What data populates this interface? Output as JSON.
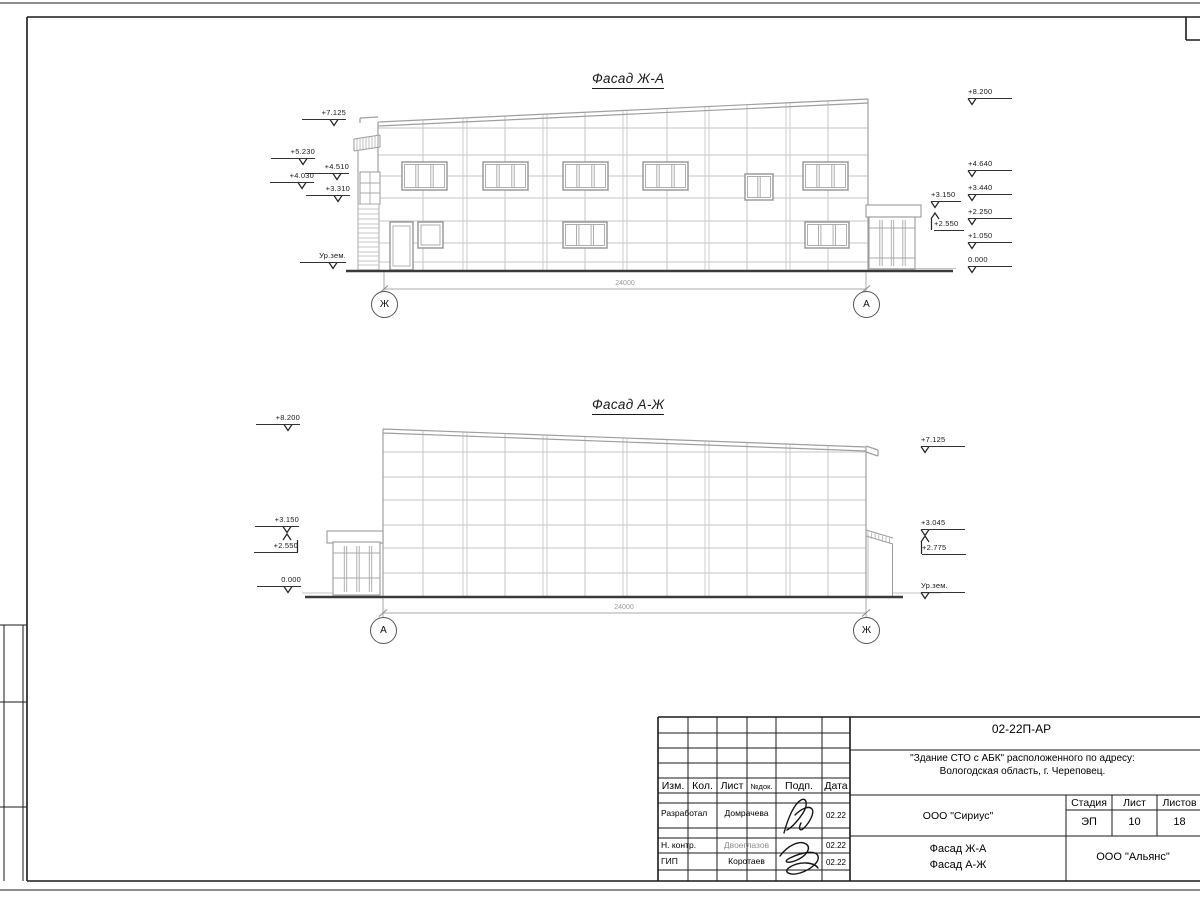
{
  "sheet": {
    "facade_top": {
      "title": "Фасад Ж-А",
      "dimension": "24000",
      "axis_left": "Ж",
      "axis_right": "А",
      "marks_left": [
        "+7.125",
        "+5.230",
        "+4.510",
        "+4.030",
        "+3.310",
        "Ур.зем."
      ],
      "marks_right": [
        "+8.200",
        "+4.640",
        "+3.440",
        "+3.150",
        "+2.250",
        "+2.550",
        "+1.050",
        "0.000"
      ]
    },
    "facade_bottom": {
      "title": "Фасад А-Ж",
      "dimension": "24000",
      "axis_left": "А",
      "axis_right": "Ж",
      "marks_left": [
        "+8.200",
        "+3.150",
        "+2.550",
        "0.000"
      ],
      "marks_right": [
        "+7.125",
        "+3.045",
        "+2.775",
        "Ур.зем."
      ]
    },
    "title_block": {
      "doc_number": "02-22П-АР",
      "project_line1": "\"Здание СТО с АБК\" расположенного по адресу:",
      "project_line2": "Вологодская область, г. Череповец.",
      "cols": {
        "izm": "Изм.",
        "kol": "Кол.",
        "list": "Лист",
        "ndoc": "№док.",
        "podp": "Подп.",
        "data": "Дата"
      },
      "rows": [
        {
          "role": "Разработал",
          "name": "Домрачева",
          "date": "02.22"
        },
        {
          "role": "Н. контр.",
          "name": "Двоеглазов",
          "date": "02.22"
        },
        {
          "role": "ГИП",
          "name": "Коротаев",
          "date": "02.22"
        }
      ],
      "org_designer": "ООО \"Сириус\"",
      "stage_label": "Стадия",
      "stage_value": "ЭП",
      "sheet_label": "Лист",
      "sheet_value": "10",
      "sheets_label": "Листов",
      "sheets_value": "18",
      "sheet_title_line1": "Фасад Ж-А",
      "sheet_title_line2": "Фасад А-Ж",
      "org_customer": "ООО \"Альянс\""
    }
  }
}
